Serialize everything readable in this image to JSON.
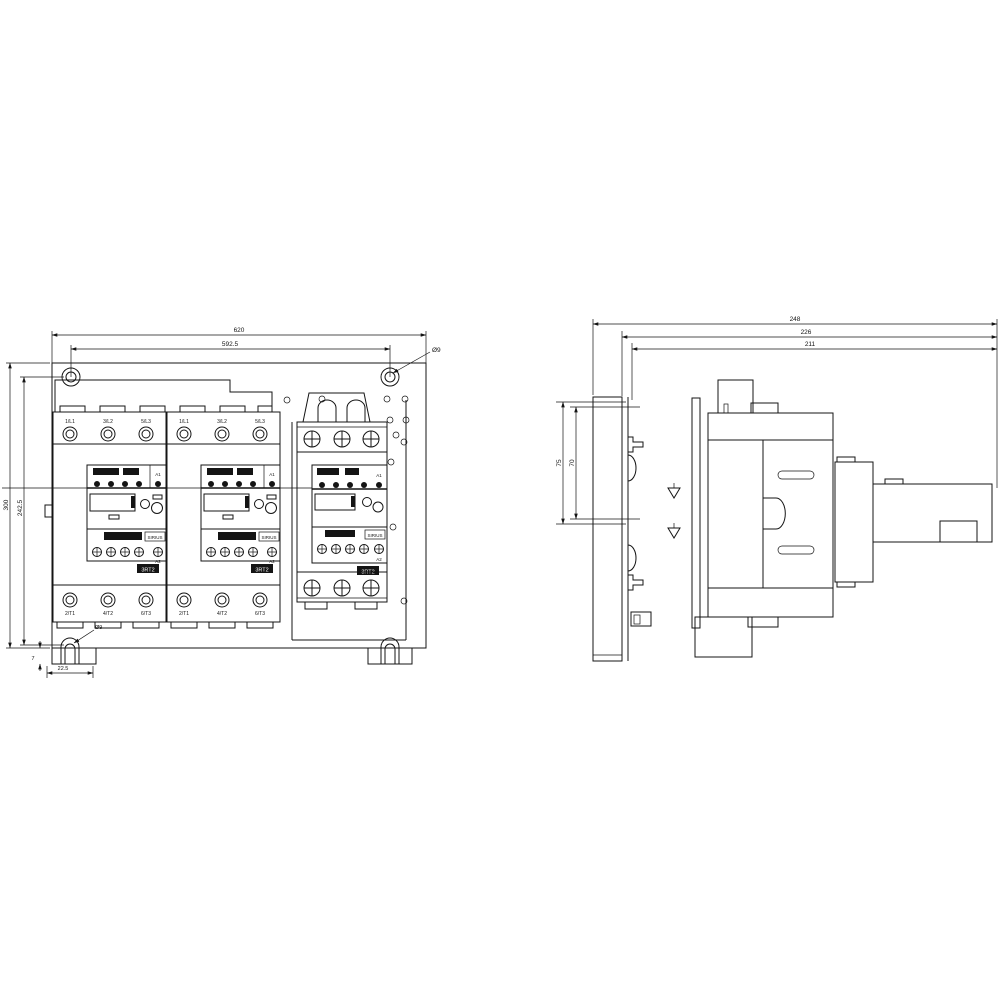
{
  "front_view": {
    "dimensions": {
      "overall_width": "620",
      "hole_spacing_width": "592.5",
      "overall_height": "300",
      "hole_spacing_height": "242.5",
      "foot_slot_width": "22.5",
      "foot_height": "7",
      "corner_hole": "Ø9",
      "foot_slot_hole": "Ø9"
    },
    "contactors": [
      {
        "terminals_top": [
          "1/L1",
          "3/L2",
          "5/L3"
        ],
        "terminals_bottom": [
          "2/T1",
          "4/T2",
          "6/T3"
        ],
        "coil_top": "A1",
        "coil_bottom": "A2",
        "brand": "SIRIUS",
        "type_label": "3RT2"
      },
      {
        "terminals_top": [
          "1/L1",
          "3/L2",
          "5/L3"
        ],
        "terminals_bottom": [
          "2/T1",
          "4/T2",
          "6/T3"
        ],
        "coil_top": "A1",
        "coil_bottom": "A2",
        "brand": "SIRIUS",
        "type_label": "3RT2"
      },
      {
        "coil_top": "A1",
        "coil_bottom": "A2",
        "brand": "SIRIUS",
        "type_label": "3RT2"
      }
    ]
  },
  "side_view": {
    "dimensions": {
      "depth_overall": "248",
      "depth_without_plate": "226",
      "depth_body": "211",
      "rail_span_outer": "75",
      "rail_span_inner": "70"
    }
  }
}
